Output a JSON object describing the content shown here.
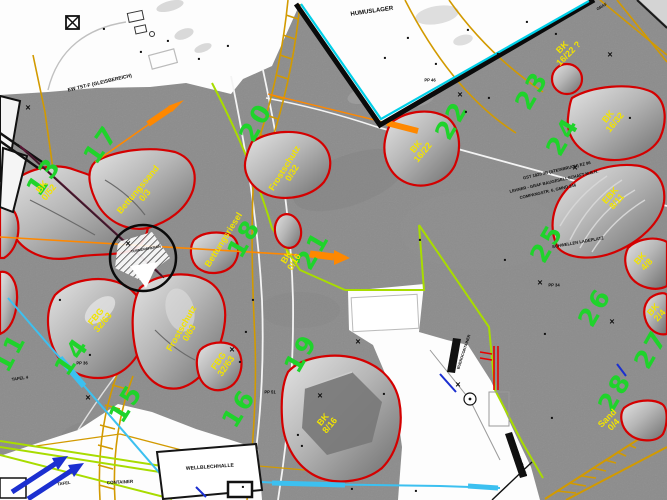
{
  "map": {
    "colors": {
      "hillshade_gray": "#8c8c8c",
      "paper_white": "#fdfdfd",
      "stockpile_outline_red": "#d40000",
      "material_label_yellow": "#f2e400",
      "zone_number_green": "#1fd32b",
      "utility_gold": "#d29a00",
      "conveyor_orange": "#ff8800",
      "boundary_black": "#0a0a0a",
      "boundary_cyan": "#00cfe8",
      "cable_cyan": "#3cc0f0",
      "line_lime": "#a8dc00",
      "arrow_blue": "#1b2fd0",
      "track_maroon": "#5c1535"
    },
    "zones": [
      {
        "n": "11",
        "x": 10,
        "y": 352,
        "rot": -62
      },
      {
        "n": "13",
        "x": 44,
        "y": 176,
        "rot": -55
      },
      {
        "n": "14",
        "x": 72,
        "y": 356,
        "rot": -55
      },
      {
        "n": "15",
        "x": 126,
        "y": 403,
        "rot": -58
      },
      {
        "n": "16",
        "x": 239,
        "y": 408,
        "rot": -58
      },
      {
        "n": "17",
        "x": 101,
        "y": 144,
        "rot": -55
      },
      {
        "n": "18",
        "x": 244,
        "y": 238,
        "rot": -60
      },
      {
        "n": "19",
        "x": 301,
        "y": 353,
        "rot": -60
      },
      {
        "n": "20",
        "x": 256,
        "y": 122,
        "rot": -60
      },
      {
        "n": "21",
        "x": 313,
        "y": 250,
        "rot": -60
      },
      {
        "n": "22",
        "x": 452,
        "y": 120,
        "rot": -60
      },
      {
        "n": "23",
        "x": 532,
        "y": 90,
        "rot": -60
      },
      {
        "n": "24",
        "x": 563,
        "y": 136,
        "rot": -60
      },
      {
        "n": "25",
        "x": 547,
        "y": 243,
        "rot": -60
      },
      {
        "n": "26",
        "x": 595,
        "y": 307,
        "rot": -60
      },
      {
        "n": "27",
        "x": 651,
        "y": 349,
        "rot": -60
      },
      {
        "n": "28",
        "x": 615,
        "y": 392,
        "rot": -60
      }
    ],
    "stockpiles": [
      {
        "lines": [
          "BK",
          "0/52"
        ],
        "x": 46,
        "y": 190,
        "rot": -52
      },
      {
        "lines": [
          "Bettungssand",
          "0/3"
        ],
        "x": 142,
        "y": 193,
        "rot": -50
      },
      {
        "lines": [
          "Frostschutz",
          "0/32"
        ],
        "x": 289,
        "y": 171,
        "rot": -58
      },
      {
        "lines": [
          "BK",
          "16/22"
        ],
        "x": 420,
        "y": 150,
        "rot": -50
      },
      {
        "lines": [
          "BK",
          "16/22 ?"
        ],
        "x": 566,
        "y": 51,
        "rot": -45
      },
      {
        "lines": [
          "BK",
          "16/32"
        ],
        "x": 612,
        "y": 120,
        "rot": -50
      },
      {
        "lines": [
          "Bettungsriesel"
        ],
        "x": 224,
        "y": 240,
        "rot": -58
      },
      {
        "lines": [
          "BK",
          "0/16"
        ],
        "x": 291,
        "y": 260,
        "rot": -58
      },
      {
        "lines": [
          "EBK",
          "8/11"
        ],
        "x": 614,
        "y": 199,
        "rot": -48
      },
      {
        "lines": [
          "BK",
          "4/8"
        ],
        "x": 644,
        "y": 262,
        "rot": -48
      },
      {
        "lines": [
          "BK",
          "2/4"
        ],
        "x": 657,
        "y": 313,
        "rot": -48
      },
      {
        "lines": [
          "FBG",
          "32/63"
        ],
        "x": 100,
        "y": 320,
        "rot": -50
      },
      {
        "lines": [
          "Frostschutz",
          "0/63"
        ],
        "x": 186,
        "y": 331,
        "rot": -60
      },
      {
        "lines": [
          "FBG",
          "32/63"
        ],
        "x": 223,
        "y": 364,
        "rot": -55
      },
      {
        "lines": [
          "BK",
          "8/16"
        ],
        "x": 327,
        "y": 423,
        "rot": -50
      },
      {
        "lines": [
          "Sand",
          "0/4"
        ],
        "x": 611,
        "y": 422,
        "rot": -45
      }
    ],
    "notes": [
      {
        "text": "HUMUSLAGER",
        "x": 372,
        "y": 12,
        "rot": -8,
        "size": 6
      },
      {
        "text": "EW TST-F (GLEISBEREICH)",
        "x": 100,
        "y": 84,
        "rot": -13,
        "size": 5
      },
      {
        "text": "GST 1820 3B (STEINBRUCH) EZ 96",
        "x": 557,
        "y": 171,
        "rot": -13,
        "size": 4.2
      },
      {
        "text": "LEHNER - GRAF BAUGESELLSCHAFT M.B.H.",
        "x": 554,
        "y": 182,
        "rot": -13,
        "size": 4.2
      },
      {
        "text": "COMPANGSTR. 6, GMND 246",
        "x": 548,
        "y": 192,
        "rot": -13,
        "size": 4.2
      },
      {
        "text": "SCHWELLEN LADEPLATZ",
        "x": 578,
        "y": 243,
        "rot": -10,
        "size": 4.2
      },
      {
        "text": "PP 46",
        "x": 430,
        "y": 81,
        "rot": 0,
        "size": 4.2
      },
      {
        "text": "PP 34",
        "x": 554,
        "y": 286,
        "rot": 0,
        "size": 4.2
      },
      {
        "text": "PP 51",
        "x": 270,
        "y": 393,
        "rot": 0,
        "size": 4.2
      },
      {
        "text": "PP 36",
        "x": 82,
        "y": 364,
        "rot": 0,
        "size": 4.2
      },
      {
        "text": "TAFEL 4",
        "x": 20,
        "y": 379,
        "rot": -8,
        "size": 4.2
      },
      {
        "text": "TAFEL",
        "x": 64,
        "y": 484,
        "rot": -8,
        "size": 4.2
      },
      {
        "text": "CONTAINER",
        "x": 120,
        "y": 483,
        "rot": -3,
        "size": 4.5
      },
      {
        "text": "WELLBLECHHALLE",
        "x": 210,
        "y": 468,
        "rot": -4,
        "size": 5
      },
      {
        "text": "BUEROCONTAINER",
        "x": 464,
        "y": 352,
        "rot": -72,
        "size": 3.8
      },
      {
        "text": "WERKSTATTCONTAINER",
        "x": 518,
        "y": 455,
        "rot": 70,
        "size": 3.8
      },
      {
        "text": "TURMDREHKRAN",
        "x": 146,
        "y": 250,
        "rot": -10,
        "size": 3.5
      },
      {
        "text": "GRAF",
        "x": 602,
        "y": 7,
        "rot": -30,
        "size": 4
      }
    ],
    "x_marks": [
      [
        28,
        108
      ],
      [
        128,
        244
      ],
      [
        460,
        95
      ],
      [
        610,
        55
      ],
      [
        540,
        283
      ],
      [
        458,
        385
      ],
      [
        232,
        350
      ],
      [
        320,
        396
      ],
      [
        575,
        168
      ],
      [
        612,
        322
      ],
      [
        88,
        398
      ],
      [
        358,
        342
      ]
    ],
    "dots": [
      [
        104,
        29
      ],
      [
        141,
        52
      ],
      [
        168,
        41
      ],
      [
        199,
        59
      ],
      [
        228,
        46
      ],
      [
        385,
        58
      ],
      [
        408,
        38
      ],
      [
        436,
        64
      ],
      [
        468,
        30
      ],
      [
        498,
        54
      ],
      [
        527,
        22
      ],
      [
        556,
        34
      ],
      [
        466,
        112
      ],
      [
        489,
        98
      ],
      [
        253,
        300
      ],
      [
        246,
        332
      ],
      [
        240,
        362
      ],
      [
        630,
        118
      ],
      [
        302,
        446
      ],
      [
        352,
        489
      ],
      [
        416,
        491
      ],
      [
        384,
        394
      ],
      [
        545,
        334
      ],
      [
        552,
        418
      ],
      [
        243,
        487
      ],
      [
        298,
        435
      ],
      [
        90,
        355
      ],
      [
        60,
        300
      ],
      [
        420,
        240
      ],
      [
        505,
        260
      ]
    ]
  }
}
